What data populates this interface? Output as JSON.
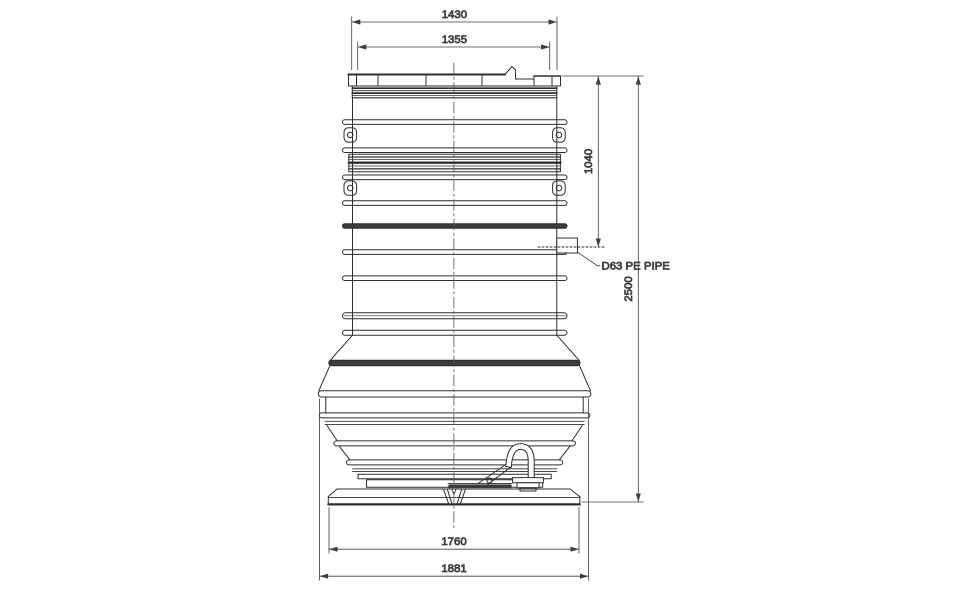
{
  "drawing": {
    "background_color": "#ffffff",
    "line_color": "#2e2e2e",
    "dimension_color": "#3f3f3f",
    "dimensions": {
      "cover_outer_width": "1430",
      "cover_inner_width": "1355",
      "inlet_depth": "1040",
      "overall_height": "2500",
      "base_width": "1760",
      "max_diameter": "1881"
    },
    "labels": {
      "inlet_pipe": "D63 PE PIPE"
    }
  }
}
